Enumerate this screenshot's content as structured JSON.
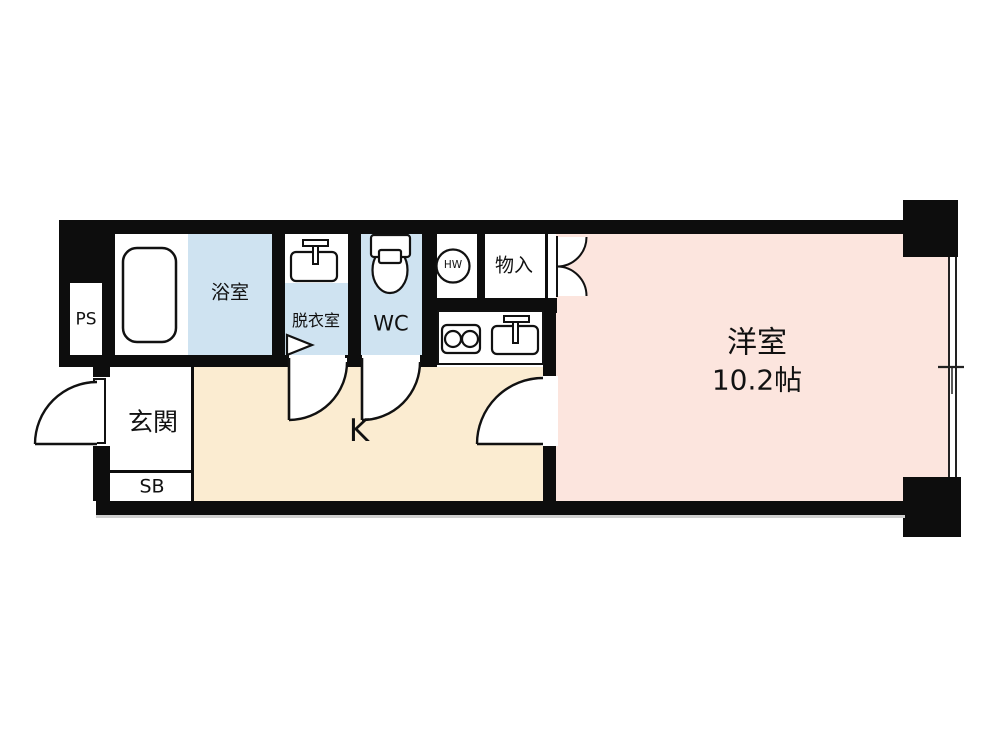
{
  "title": "apartment-floor-plan",
  "colors": {
    "wall": "#0d0d0d",
    "ink": "#111111",
    "water_blue": "#cfe3f1",
    "room_pink": "#fce5de",
    "kitchen_beige": "#fbecd1"
  },
  "rooms": {
    "ps": {
      "label": "PS"
    },
    "bath": {
      "label": "浴室"
    },
    "dressing": {
      "label": "脱衣室"
    },
    "toilet": {
      "label": "WC"
    },
    "water_heater": {
      "label": "HW"
    },
    "storage": {
      "label": "物入"
    },
    "western": {
      "label": "洋室",
      "size": "10.2帖"
    },
    "entrance": {
      "label": "玄関"
    },
    "shoe_box": {
      "label": "SB"
    },
    "kitchen": {
      "label": "K"
    }
  }
}
